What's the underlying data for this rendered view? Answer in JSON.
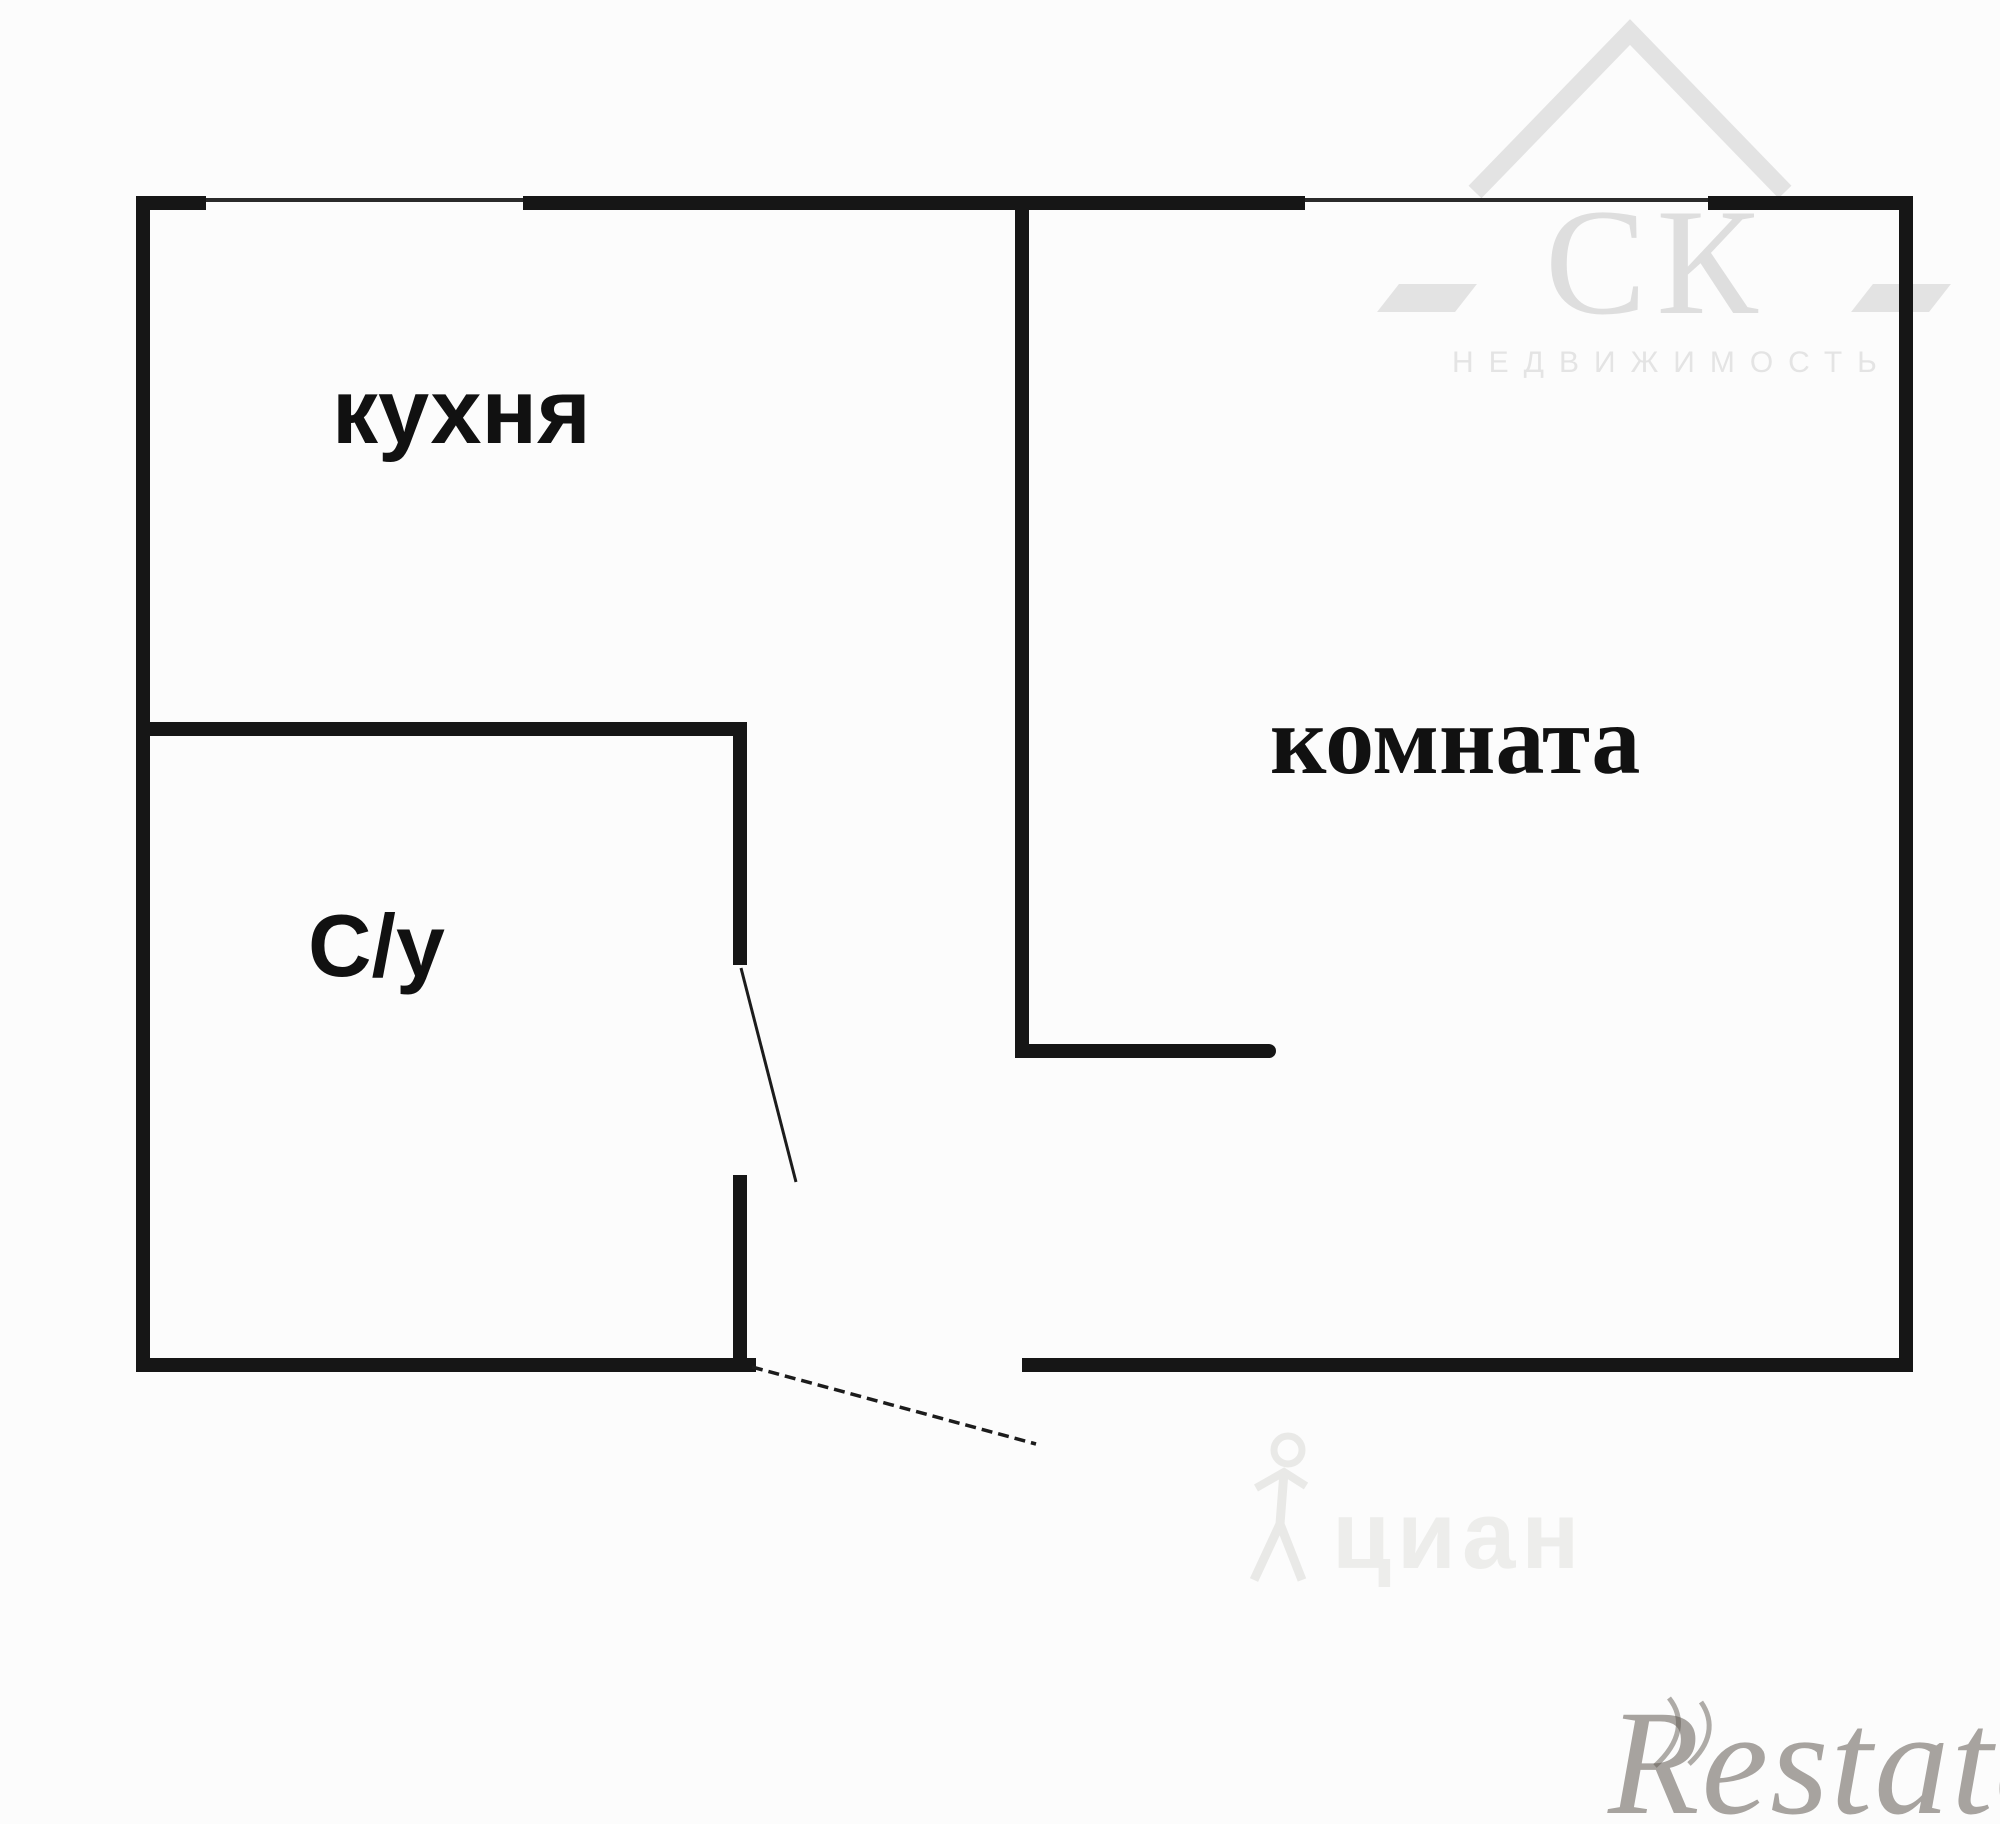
{
  "page": {
    "background": "#fcfcfc",
    "kind": "apartment floor plan"
  },
  "plan": {
    "wall_color": "#161616",
    "rooms": [
      {
        "id": "kitchen",
        "label": "кухня"
      },
      {
        "id": "room",
        "label": "комната"
      },
      {
        "id": "bathroom",
        "label": "С/у"
      }
    ]
  },
  "watermarks": {
    "agency": {
      "name": "СК",
      "subtitle": "НЕДВИЖИМОСТЬ",
      "color": "#dedede"
    },
    "cian": {
      "text": "циан",
      "color": "#ededeb"
    },
    "restate": {
      "text": "Restate",
      "color": "#605a52"
    }
  }
}
